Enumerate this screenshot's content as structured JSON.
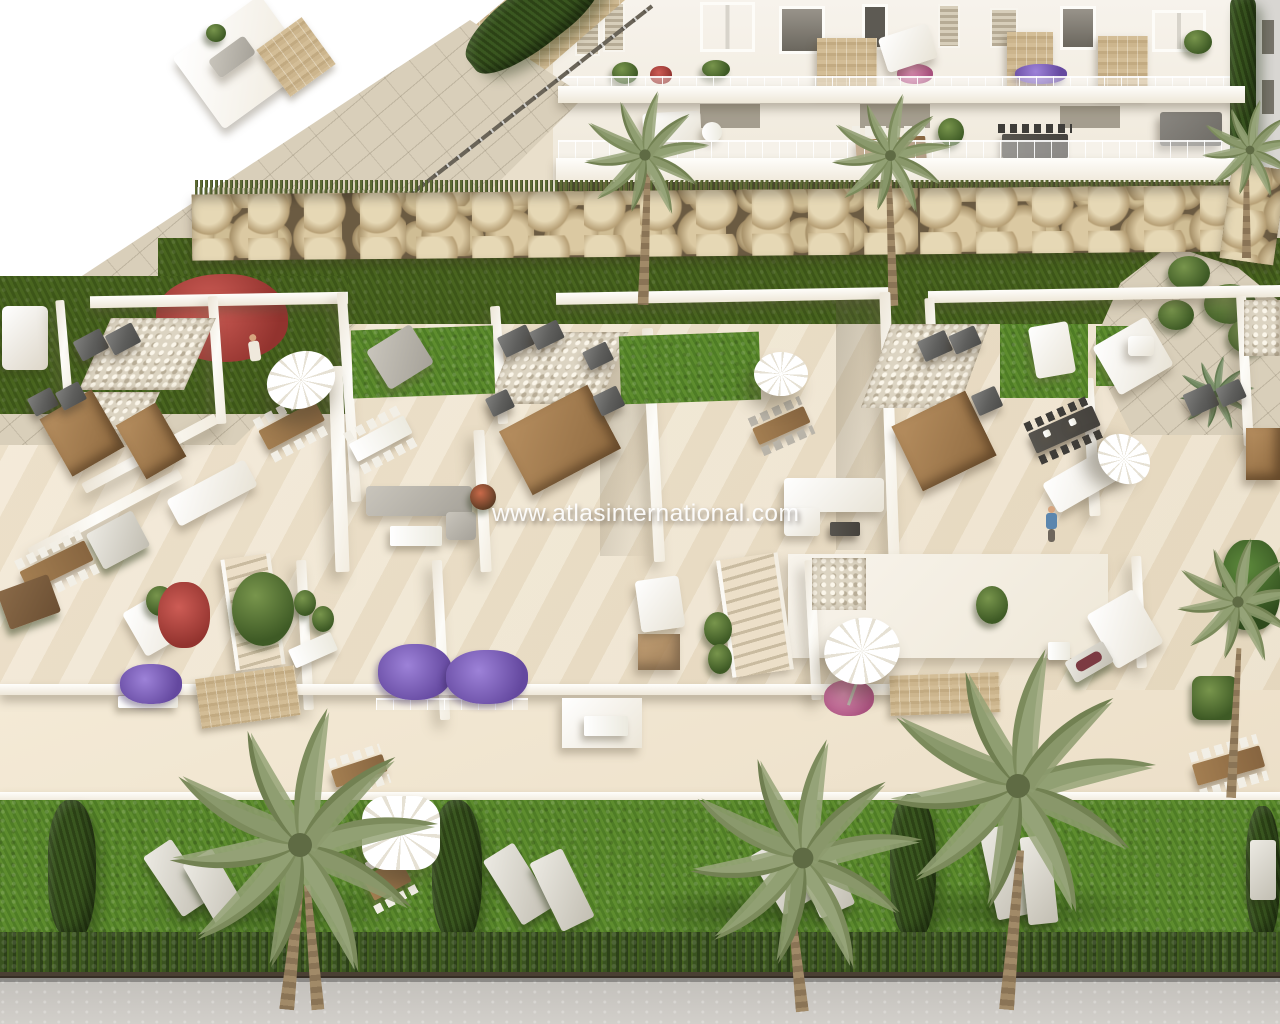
{
  "image": {
    "kind": "3d-architectural-render",
    "view": "aerial",
    "subject": "Modern white residential development: apartment block with furnished terraces, gabion rock wall, rooftop townhouse terraces, gardens with palm trees and a street"
  },
  "watermark": {
    "text": "www.atlasinternational.com"
  },
  "palette": {
    "blank_corner": "#ffffff",
    "building_white": "#f7f3ec",
    "wall_shadow_face": "#e4dccd",
    "terrace_floor": "#efe4cd",
    "stone_cladding": "#c9b28a",
    "gravel": "#dcd4c2",
    "rock_wall": "#c4ae85",
    "lawn_bright": "#558527",
    "lawn_dark": "#42601f",
    "hedge_dark": "#31491b",
    "palm_green": "#8d9a74",
    "ac_unit_gray": "#5e5e5c",
    "wood_brown": "#a37e51",
    "flower_purple": "#7a5fb5",
    "flower_pink": "#c76d9b",
    "flower_red": "#b04a42",
    "road_gray": "#cac7c2",
    "watermark_white": "rgba(255,255,255,0.93)"
  },
  "scene": {
    "objects": [
      "apartment-terraces",
      "stone-cladding-panels",
      "louvered-shutters",
      "glass-railings",
      "gabion-rock-wall",
      "lawns",
      "boundary-wall-with-path",
      "rooftop-terraces",
      "party-walls",
      "air-conditioning-units",
      "outdoor-shower-niches",
      "parasols",
      "dining-sets",
      "outdoor-sofas",
      "sun-loungers",
      "day-beds",
      "staircases",
      "planters-purple",
      "planters-pink",
      "potted-plants",
      "palm-trees",
      "cypress-hedges",
      "hedgerow",
      "street",
      "people-figures"
    ]
  }
}
